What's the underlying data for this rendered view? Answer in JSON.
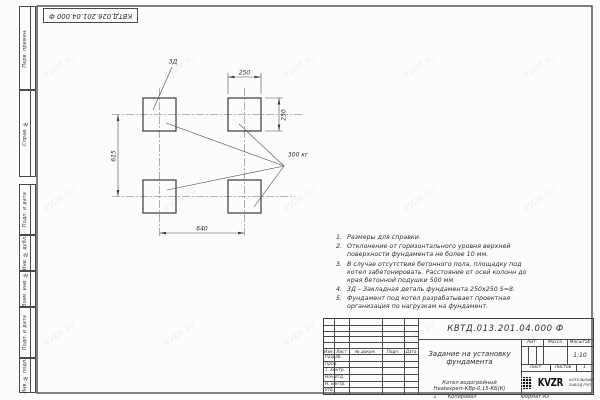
{
  "sheet": {
    "watermark": "KVZR.RU",
    "corner_designation": "КВТД.026.201.04.000 Ф",
    "side_labels": [
      "Перв. примен.",
      "Справ. №",
      "Подп. и дата",
      "Инв. № дубл.",
      "Взам. инв. №",
      "Подп. и дата",
      "Инв. № подл."
    ],
    "footer": {
      "zone": "1",
      "copied": "Копировал",
      "format": "Формат А3"
    }
  },
  "drawing": {
    "embed_label": "3Д",
    "dim_top": "250",
    "dim_right": "250",
    "dim_left": "615",
    "dim_bottom": "640",
    "mass_label": "300 кг"
  },
  "notes": [
    {
      "num": "1.",
      "text": "Размеры для справки."
    },
    {
      "num": "2.",
      "text": "Отклонение от горизонтального уровня верхней поверхности фундамента не более 10 мм."
    },
    {
      "num": "3.",
      "text": "В случае отсутствия бетонного пола, площадку под котел забетонировать. Расстояние от осей колонн до края бетонной подушки 500 мм."
    },
    {
      "num": "4.",
      "text": "3Д – Закладная деталь фундамента 250х250 S=8."
    },
    {
      "num": "5.",
      "text": "Фундамент под котел разрабатывает проектная организация по нагрузкам на фундамент."
    }
  ],
  "title_block": {
    "designation": "КВТД.013.201.04.000 Ф",
    "title_line1": "Задание на установку",
    "title_line2": "фундамента",
    "product_line1": "Котел водогрейный",
    "product_line2": "Heatexpert-КВр-0,15-КБ(К)",
    "col_headers": [
      "Изм.",
      "Лист",
      "№ докум.",
      "Подп.",
      "Дата"
    ],
    "sign_rows": [
      "Разраб.",
      "Пров.",
      "Т. контр.",
      "Нач.отд.",
      "Н. контр.",
      "Утв."
    ],
    "lit_label": "Лит.",
    "mass_label": "Масса",
    "scale_label": "Масштаб",
    "scale_value": "1:10",
    "sheet_label": "Лист",
    "sheets_label": "Листов",
    "sheets_value": "1",
    "logo_text": "KVZR",
    "logo_sub1": "КОТЕЛЬНЫЙ",
    "logo_sub2": "ЗАВОД РЭП"
  }
}
